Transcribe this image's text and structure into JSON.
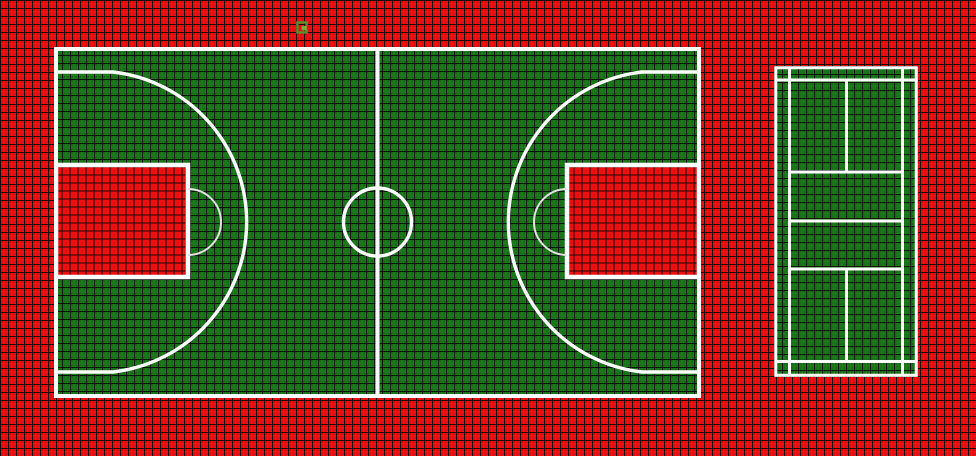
{
  "app": {
    "name": "Sport court tile layout canvas",
    "description": "Top-down view of modular perforated sport tiles: red background surface with a green basketball court and a green badminton court"
  },
  "canvas": {
    "width_px": 976,
    "height_px": 456,
    "tile_size_px": 8
  },
  "colors": {
    "bg_red": "#ee1010",
    "court_green": "#1a7a1a",
    "grid_black": "rgba(8,8,8,0.9)",
    "line_white": "#ffffff",
    "throw_arc_gray": "#e2e2e2",
    "cursor_olive": "#5c8f2e",
    "cursor_bright": "#79ad3f"
  },
  "courts": {
    "basketball": {
      "label": "basketball-court",
      "x": 54,
      "y": 47,
      "width": 647,
      "height": 351,
      "features": [
        "white boundary rectangle",
        "center line",
        "center circle r=34",
        "left and right red painted keys 134x112 with white outline",
        "free-throw semicircles r=33",
        "three-point lines r=151 with straight baseline segments"
      ]
    },
    "badminton": {
      "label": "badminton-court",
      "x": 774,
      "y": 66,
      "width": 144,
      "height": 311,
      "features": [
        "white boundary rectangle",
        "two singles side lines full length",
        "long service lines near each end full width",
        "two short service lines and net line between side lines",
        "center line segments in each service half"
      ]
    }
  },
  "cursor": {
    "label": "tile-cursor-marker",
    "x": 296,
    "y": 21,
    "width": 13,
    "height": 13
  }
}
